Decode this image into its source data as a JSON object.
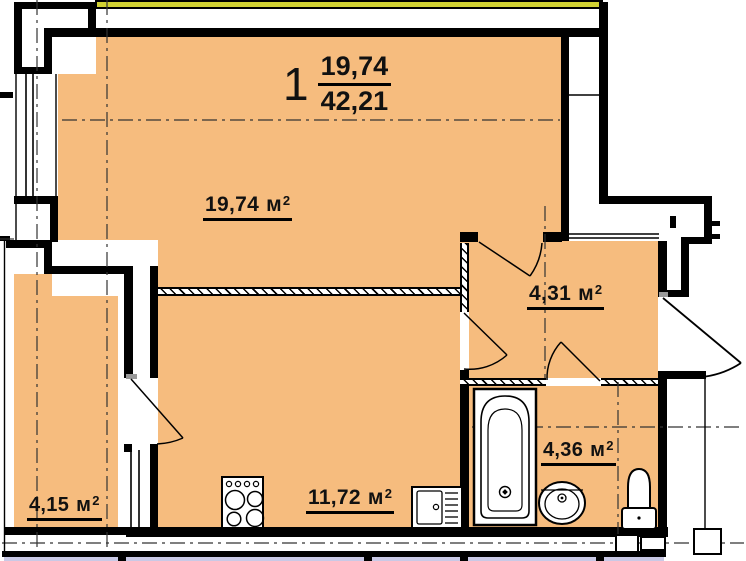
{
  "apartment": {
    "type_number": "1",
    "living_area": "19,74",
    "total_area": "42,21"
  },
  "rooms": {
    "living": {
      "area": "19,74",
      "unit": "м",
      "sup": "2"
    },
    "hallway": {
      "area": "4,31",
      "unit": "м",
      "sup": "2"
    },
    "bathroom": {
      "area": "4,36",
      "unit": "м",
      "sup": "2"
    },
    "kitchen": {
      "area": "11,72",
      "unit": "м",
      "sup": "2"
    },
    "balcony": {
      "area": "4,15",
      "unit": "м",
      "sup": "2"
    }
  },
  "colors": {
    "room_fill": "#f6bc7e",
    "accent_band": "#d2d233",
    "neighbor_fill": "#c9c9e6",
    "wall": "#000000"
  },
  "fixtures": {
    "bathtub": "bathtub",
    "wash_basin": "wash-basin",
    "toilet": "toilet",
    "stove": "stove",
    "kitchen_sink": "kitchen-sink"
  }
}
